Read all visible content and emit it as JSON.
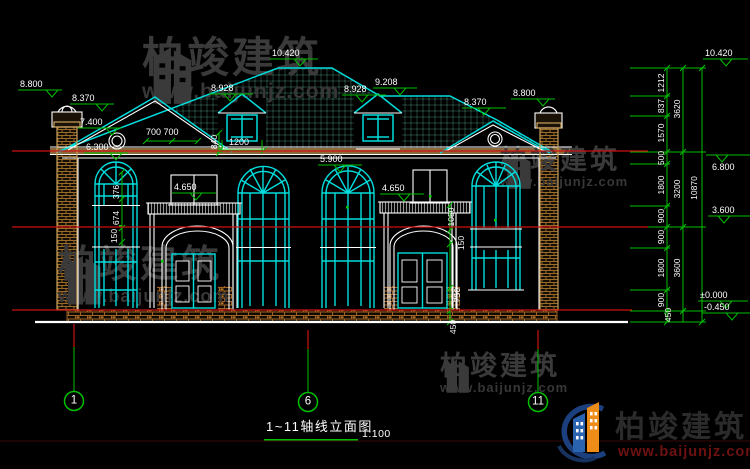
{
  "brand": {
    "cn": "柏竣建筑",
    "url": "www.baijunjz.com"
  },
  "title_block": {
    "title": "1~11轴线立面图",
    "scale": "1:100"
  },
  "colors": {
    "line_cyan": "#00dddd",
    "dim_green": "#00c000",
    "level_red": "#cc1111",
    "text_white": "#ffffff",
    "brick_tan": "#c9a15a",
    "watermark_gray": "#3a3a3a",
    "logo_blue": "#2a63b0",
    "logo_orange": "#ee8c1a",
    "logo_url_red": "#6e1111"
  },
  "axis_bubbles": [
    "1",
    "6",
    "11"
  ],
  "labels": [
    {
      "n": "elev-8800-left",
      "t": "8.800",
      "x": 20,
      "y": 80,
      "c": "d"
    },
    {
      "n": "elev-8370-left",
      "t": "8.370",
      "x": 72,
      "y": 94,
      "c": "d"
    },
    {
      "n": "elev-7400-left",
      "t": "7.400",
      "x": 80,
      "y": 118,
      "c": "d"
    },
    {
      "n": "elev-6300-left",
      "t": "6.300",
      "x": 86,
      "y": 143,
      "c": "d"
    },
    {
      "n": "dim-700-700",
      "t": "700 700",
      "x": 146,
      "y": 128,
      "c": "d"
    },
    {
      "n": "elev-8928-left",
      "t": "8.928",
      "x": 211,
      "y": 84,
      "c": "d"
    },
    {
      "n": "elev-10420-ridge",
      "t": "10.420",
      "x": 272,
      "y": 49,
      "c": "d"
    },
    {
      "n": "elev-8928-right",
      "t": "8.928",
      "x": 344,
      "y": 85,
      "c": "d"
    },
    {
      "n": "elev-9208",
      "t": "9.208",
      "x": 375,
      "y": 78,
      "c": "d"
    },
    {
      "n": "dim-1200",
      "t": "1200",
      "x": 229,
      "y": 138,
      "c": "d"
    },
    {
      "n": "elev-8370-right",
      "t": "8.370",
      "x": 464,
      "y": 98,
      "c": "d"
    },
    {
      "n": "elev-8800-right",
      "t": "8.800",
      "x": 513,
      "y": 89,
      "c": "d"
    },
    {
      "n": "elev-5900",
      "t": "5.900",
      "x": 320,
      "y": 155,
      "c": "d"
    },
    {
      "n": "elev-4650-left",
      "t": "4.650",
      "x": 174,
      "y": 183,
      "c": "d"
    },
    {
      "n": "elev-4650-right",
      "t": "4.650",
      "x": 382,
      "y": 184,
      "c": "d"
    },
    {
      "n": "elev-10420-right",
      "t": "10.420",
      "x": 705,
      "y": 49,
      "c": "d"
    },
    {
      "n": "elev-6800-right",
      "t": "6.800",
      "x": 712,
      "y": 163,
      "c": "d"
    },
    {
      "n": "elev-3600-right",
      "t": "3.600",
      "x": 712,
      "y": 206,
      "c": "d"
    },
    {
      "n": "elev-0000-right",
      "t": "±0.000",
      "x": 700,
      "y": 291,
      "c": "d"
    },
    {
      "n": "elev-0450-right",
      "t": "-0.450",
      "x": 704,
      "y": 303,
      "c": "d"
    },
    {
      "n": "dim-376",
      "t": "376",
      "x": 116,
      "y": 192,
      "c": "v"
    },
    {
      "n": "dim-674",
      "t": "674",
      "x": 116,
      "y": 218,
      "c": "v"
    },
    {
      "n": "dim-150-left",
      "t": "150",
      "x": 114,
      "y": 236,
      "c": "v"
    },
    {
      "n": "dim-840",
      "t": "840",
      "x": 214,
      "y": 142,
      "c": "v"
    },
    {
      "n": "dim-1050",
      "t": "1050",
      "x": 451,
      "y": 217,
      "c": "v"
    },
    {
      "n": "dim-150-right",
      "t": "150",
      "x": 461,
      "y": 243,
      "c": "v"
    },
    {
      "n": "dim-750",
      "t": "750",
      "x": 457,
      "y": 295,
      "c": "v"
    },
    {
      "n": "dim-450-door",
      "t": "450",
      "x": 453,
      "y": 327,
      "c": "v"
    },
    {
      "n": "dim-1212",
      "t": "1212",
      "x": 661,
      "y": 83,
      "c": "v"
    },
    {
      "n": "dim-837",
      "t": "837",
      "x": 661,
      "y": 106,
      "c": "v"
    },
    {
      "n": "dim-1570",
      "t": "1570",
      "x": 661,
      "y": 133,
      "c": "v"
    },
    {
      "n": "dim-500",
      "t": "500",
      "x": 661,
      "y": 158,
      "c": "v"
    },
    {
      "n": "dim-1800-a",
      "t": "1800",
      "x": 661,
      "y": 185,
      "c": "v"
    },
    {
      "n": "dim-900-a",
      "t": "900",
      "x": 661,
      "y": 216,
      "c": "v"
    },
    {
      "n": "dim-900-b",
      "t": "900",
      "x": 661,
      "y": 237,
      "c": "v"
    },
    {
      "n": "dim-1800-b",
      "t": "1800",
      "x": 661,
      "y": 268,
      "c": "v"
    },
    {
      "n": "dim-900-c",
      "t": "900",
      "x": 661,
      "y": 300,
      "c": "v"
    },
    {
      "n": "dim-450-right",
      "t": "450",
      "x": 668,
      "y": 315,
      "c": "v"
    },
    {
      "n": "dim-3620",
      "t": "3620",
      "x": 677,
      "y": 109,
      "c": "v"
    },
    {
      "n": "dim-3200",
      "t": "3200",
      "x": 677,
      "y": 189,
      "c": "v"
    },
    {
      "n": "dim-3600",
      "t": "3600",
      "x": 677,
      "y": 268,
      "c": "v"
    },
    {
      "n": "dim-10870",
      "t": "10870",
      "x": 694,
      "y": 188,
      "c": "v"
    },
    {
      "n": "axis-1",
      "t": "1",
      "x": 74,
      "y": 401,
      "c": "ax"
    },
    {
      "n": "axis-6",
      "t": "6",
      "x": 308,
      "y": 402,
      "c": "ax"
    },
    {
      "n": "axis-11",
      "t": "11",
      "x": 538,
      "y": 402,
      "c": "ax"
    },
    {
      "n": "drawing-title",
      "t": "1~11轴线立面图",
      "x": 266,
      "y": 420,
      "c": "t"
    },
    {
      "n": "drawing-scale",
      "t": "1:100",
      "x": 362,
      "y": 429,
      "c": "s"
    }
  ]
}
